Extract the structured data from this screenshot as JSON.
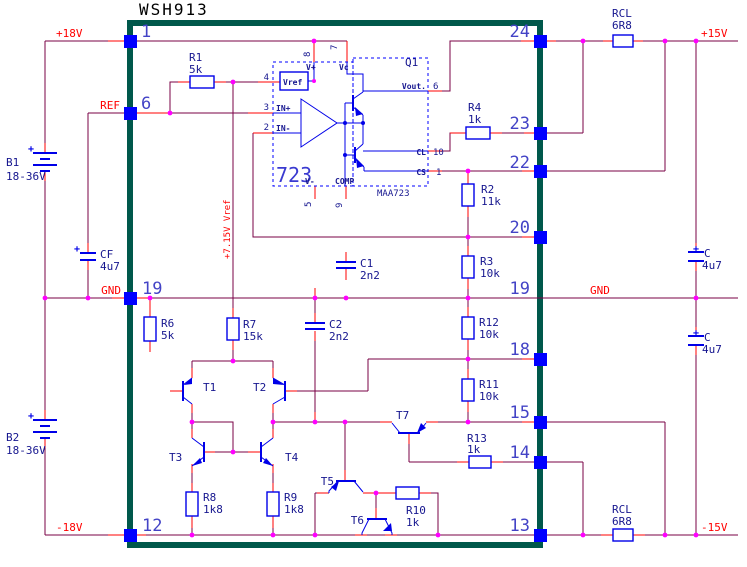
{
  "title": "WSH913",
  "colors": {
    "wire": "#7A0045",
    "lead_stub": "#FF0000",
    "component": "#0000E8",
    "box": "#00584B",
    "pin_square": "#0000FF",
    "junction": "#FF00FF",
    "pin_number": "#4343C6",
    "label": "#16168F",
    "net_label": "#FF0000"
  },
  "power_labels": {
    "p18": "+18V",
    "ref": "REF",
    "gnd_left": "GND",
    "n18": "-18V",
    "p15": "+15V",
    "gnd_right": "GND",
    "n15": "-15V",
    "vref_rail": "+7.15V Vref"
  },
  "pins_left": [
    "1",
    "6",
    "19",
    "12"
  ],
  "pins_right": [
    "24",
    "23",
    "22",
    "20",
    "19",
    "18",
    "15",
    "14",
    "13"
  ],
  "ic": {
    "name": "723",
    "part": "MAA723",
    "q": "Q1",
    "vref_box": "Vref",
    "labels": {
      "vplus": "V+",
      "vc": "Vc",
      "inp": "IN+",
      "inn": "IN-",
      "vminus": "V-",
      "comp": "COMP",
      "vout": "Vout.",
      "cl": "CL",
      "cs": "CS"
    },
    "pin_numbers": {
      "p4": "4",
      "p3": "3",
      "p2": "2",
      "p8": "8",
      "p7": "7",
      "p5": "5",
      "p9": "9",
      "p6": "6",
      "p10": "10",
      "p1": "1"
    }
  },
  "components": {
    "r1": {
      "ref": "R1",
      "value": "5k"
    },
    "r2": {
      "ref": "R2",
      "value": "11k"
    },
    "r3": {
      "ref": "R3",
      "value": "10k"
    },
    "r4": {
      "ref": "R4",
      "value": "1k"
    },
    "r6": {
      "ref": "R6",
      "value": "5k"
    },
    "r7": {
      "ref": "R7",
      "value": "15k"
    },
    "r8": {
      "ref": "R8",
      "value": "1k8"
    },
    "r9": {
      "ref": "R9",
      "value": "1k8"
    },
    "r10": {
      "ref": "R10",
      "value": "1k"
    },
    "r11": {
      "ref": "R11",
      "value": "10k"
    },
    "r12": {
      "ref": "R12",
      "value": "10k"
    },
    "r13": {
      "ref": "R13",
      "value": "1k"
    },
    "rcl_top": {
      "ref": "RCL",
      "value": "6R8"
    },
    "rcl_bottom": {
      "ref": "RCL",
      "value": "6R8"
    },
    "c1": {
      "ref": "C1",
      "value": "2n2"
    },
    "c2": {
      "ref": "C2",
      "value": "2n2"
    },
    "cf": {
      "ref": "CF",
      "value": "4u7",
      "plus": "+"
    },
    "c_top": {
      "ref": "C",
      "value": "4u7",
      "plus": "+"
    },
    "c_bottom": {
      "ref": "C",
      "value": "4u7",
      "plus": "+"
    },
    "b1": {
      "ref": "B1",
      "value": "18-36V",
      "plus": "+"
    },
    "b2": {
      "ref": "B2",
      "value": "18-36V",
      "plus": "+"
    },
    "t1": {
      "ref": "T1"
    },
    "t2": {
      "ref": "T2"
    },
    "t3": {
      "ref": "T3"
    },
    "t4": {
      "ref": "T4"
    },
    "t5": {
      "ref": "T5"
    },
    "t6": {
      "ref": "T6"
    },
    "t7": {
      "ref": "T7"
    }
  }
}
